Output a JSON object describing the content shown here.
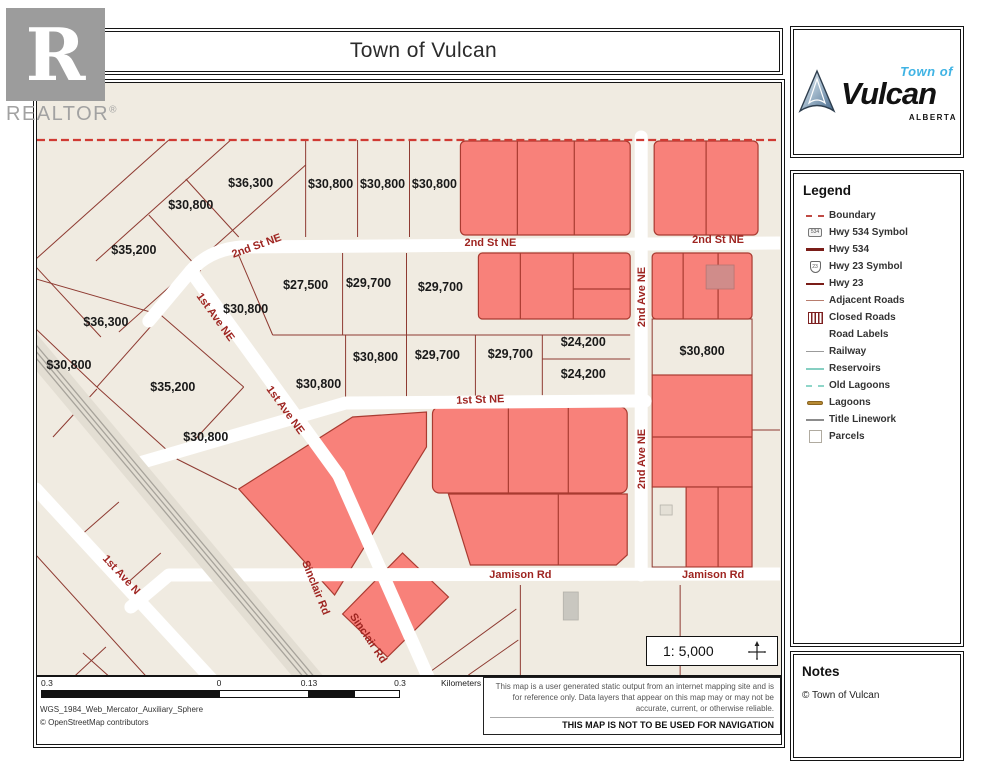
{
  "title": "Town of Vulcan",
  "realtor": {
    "letter": "R",
    "label": "REALTOR",
    "reg": "®"
  },
  "vulcan_logo": {
    "town_of": "Town of",
    "name": "Vulcan",
    "province": "ALBERTA"
  },
  "legend": {
    "title": "Legend",
    "items": [
      {
        "label": "Boundary",
        "icon": "boundary"
      },
      {
        "label": "Hwy 534 Symbol",
        "icon": "hwy534-sym",
        "icon_text": "534"
      },
      {
        "label": "Hwy 534",
        "icon": "hwy534"
      },
      {
        "label": "Hwy 23 Symbol",
        "icon": "hwy23-sym",
        "icon_text": "23"
      },
      {
        "label": "Hwy 23",
        "icon": "hwy23"
      },
      {
        "label": "Adjacent Roads",
        "icon": "adjacent"
      },
      {
        "label": "Closed Roads",
        "icon": "closed"
      },
      {
        "label": "Road Labels",
        "icon": "none"
      },
      {
        "label": "Railway",
        "icon": "railway"
      },
      {
        "label": "Reservoirs",
        "icon": "reservoir"
      },
      {
        "label": "Old Lagoons",
        "icon": "oldlagoon"
      },
      {
        "label": "Lagoons",
        "icon": "lagoon"
      },
      {
        "label": "Title Linework",
        "icon": "titlework"
      },
      {
        "label": "Parcels",
        "icon": "parcels"
      }
    ]
  },
  "notes": {
    "title": "Notes",
    "text": "© Town of Vulcan"
  },
  "map": {
    "scale_text": "1: 5,000",
    "colors": {
      "background": "#f0ebe1",
      "parcel_red": "#f8817a",
      "parcel_line": "#8e3a31",
      "street_label": "#9e2420",
      "boundary": "#d03a33"
    },
    "price_labels": [
      {
        "t": "$36,300",
        "x": 250,
        "y": 190
      },
      {
        "t": "$30,800",
        "x": 190,
        "y": 212
      },
      {
        "t": "$35,200",
        "x": 133,
        "y": 257
      },
      {
        "t": "$30,800",
        "x": 330,
        "y": 191
      },
      {
        "t": "$30,800",
        "x": 382,
        "y": 191
      },
      {
        "t": "$30,800",
        "x": 434,
        "y": 191
      },
      {
        "t": "$27,500",
        "x": 305,
        "y": 292
      },
      {
        "t": "$29,700",
        "x": 368,
        "y": 290
      },
      {
        "t": "$29,700",
        "x": 440,
        "y": 294
      },
      {
        "t": "$30,800",
        "x": 245,
        "y": 316
      },
      {
        "t": "$36,300",
        "x": 105,
        "y": 329
      },
      {
        "t": "$30,800",
        "x": 68,
        "y": 372
      },
      {
        "t": "$35,200",
        "x": 172,
        "y": 394
      },
      {
        "t": "$30,800",
        "x": 205,
        "y": 444
      },
      {
        "t": "$30,800",
        "x": 318,
        "y": 391
      },
      {
        "t": "$30,800",
        "x": 375,
        "y": 364
      },
      {
        "t": "$29,700",
        "x": 437,
        "y": 362
      },
      {
        "t": "$29,700",
        "x": 510,
        "y": 361
      },
      {
        "t": "$24,200",
        "x": 583,
        "y": 349
      },
      {
        "t": "$24,200",
        "x": 583,
        "y": 381
      },
      {
        "t": "$30,800",
        "x": 702,
        "y": 358
      }
    ],
    "street_labels": [
      {
        "t": "2nd St NE",
        "x": 257,
        "y": 252,
        "r": -20
      },
      {
        "t": "2nd St NE",
        "x": 490,
        "y": 249,
        "r": 0
      },
      {
        "t": "2nd St NE",
        "x": 718,
        "y": 246,
        "r": 0
      },
      {
        "t": "1st St NE",
        "x": 480,
        "y": 406,
        "r": -2
      },
      {
        "t": "2nd Ave NE",
        "x": 645,
        "y": 300,
        "r": -90
      },
      {
        "t": "2nd Ave NE",
        "x": 645,
        "y": 462,
        "r": -90
      },
      {
        "t": "1st Ave NE",
        "x": 212,
        "y": 322,
        "r": 54
      },
      {
        "t": "1st Ave NE",
        "x": 282,
        "y": 415,
        "r": 54
      },
      {
        "t": "1st Ave N",
        "x": 118,
        "y": 580,
        "r": 47
      },
      {
        "t": "Sinclair Rd",
        "x": 312,
        "y": 592,
        "r": 68
      },
      {
        "t": "Sinclair Rd",
        "x": 365,
        "y": 643,
        "r": 56
      },
      {
        "t": "Jamison Rd",
        "x": 520,
        "y": 581,
        "r": 0
      },
      {
        "t": "Jamison Rd",
        "x": 713,
        "y": 581,
        "r": 0
      }
    ]
  },
  "scalebar": {
    "labels": [
      {
        "t": "0.3",
        "x": 4,
        "edge": true
      },
      {
        "t": "0",
        "x": 182,
        "edge": false
      },
      {
        "t": "0.13",
        "x": 272,
        "edge": false
      },
      {
        "t": "0.3",
        "x": 363,
        "edge": false
      }
    ],
    "units": "Kilometers",
    "segments": [
      {
        "w": 178,
        "c": "#111"
      },
      {
        "w": 90,
        "c": "#fff"
      },
      {
        "w": 45,
        "c": "#111"
      },
      {
        "w": 46,
        "c": "#fff"
      }
    ]
  },
  "footer": {
    "projection": "WGS_1984_Web_Mercator_Auxiliary_Sphere",
    "credit": "© OpenStreetMap contributors",
    "disclaimer": "This map is a user generated static output from an internet mapping site and is for reference only. Data layers that appear on this map may or may not be accurate, current, or otherwise reliable.",
    "warning": "THIS MAP IS NOT TO BE USED FOR NAVIGATION"
  }
}
